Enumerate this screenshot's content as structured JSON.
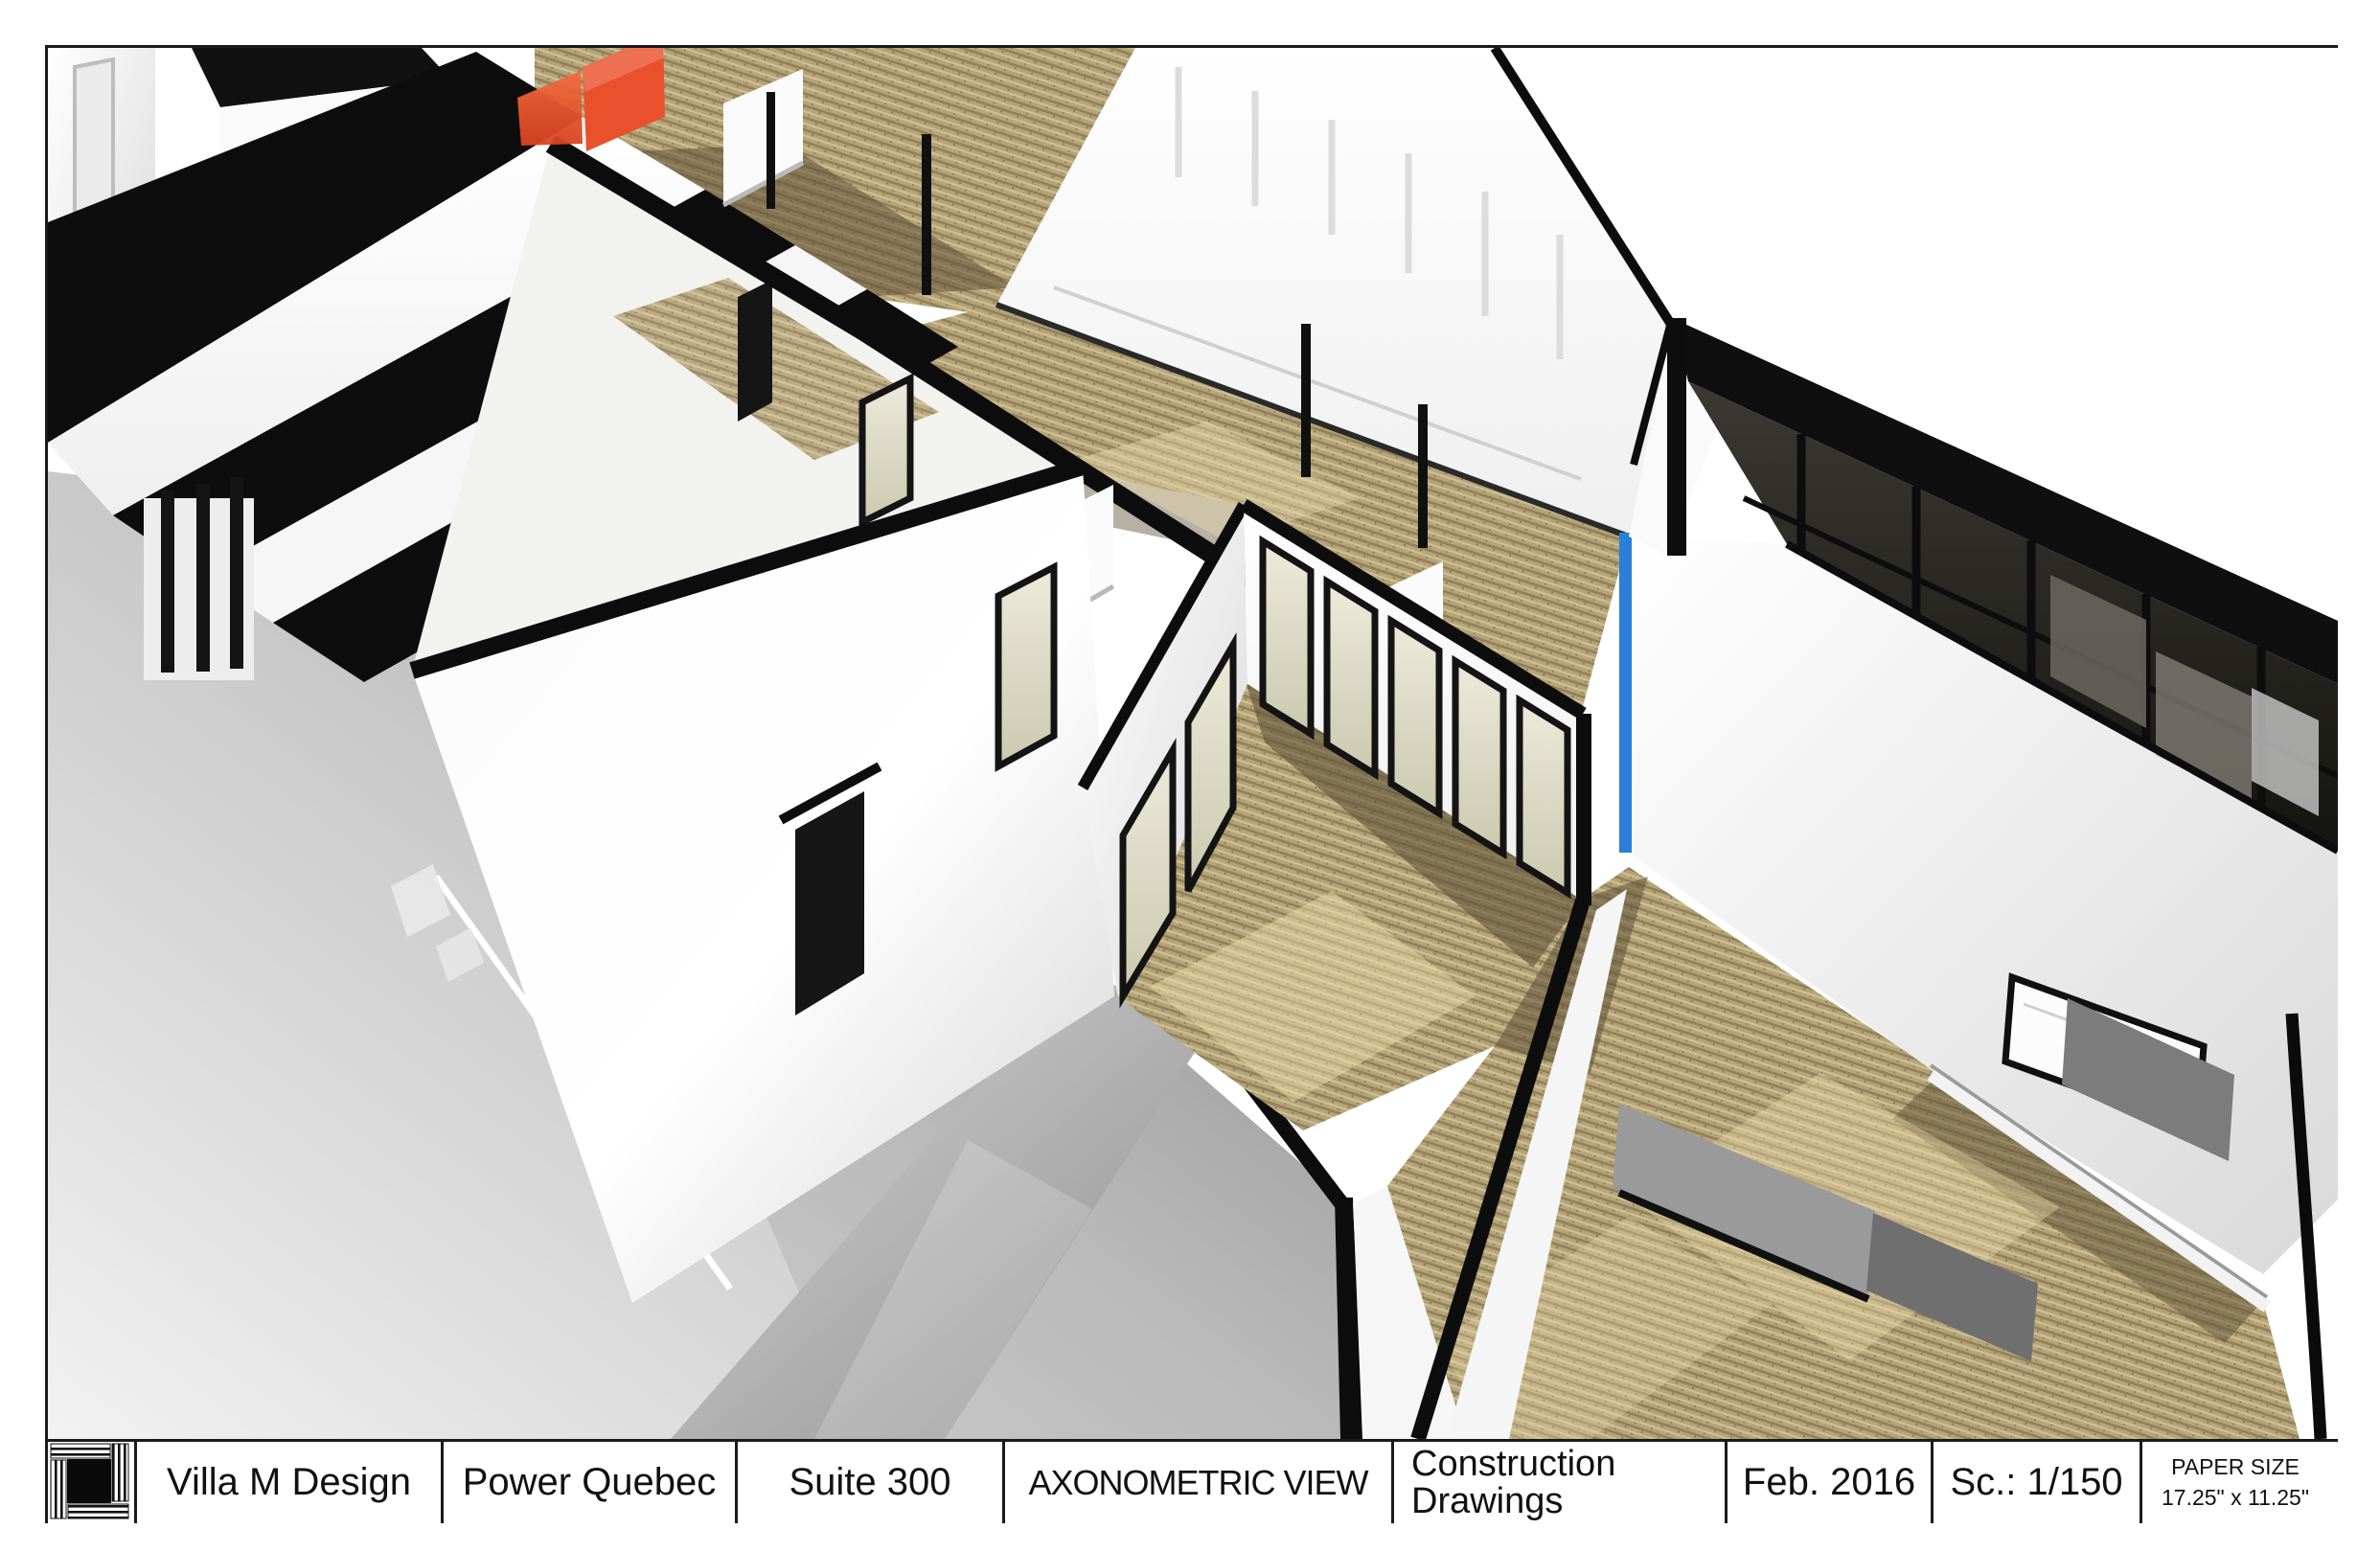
{
  "title_block": {
    "designer": "Villa M Design",
    "client": "Power Quebec",
    "suite": "Suite 300",
    "view_title": "AXONOMETRIC VIEW",
    "drawing_set_line1": "Construction",
    "drawing_set_line2": "Drawings",
    "date": "Feb. 2016",
    "scale": "Sc.: 1/150",
    "paper_size_label": "PAPER SIZE",
    "paper_size_value": "17.25\" x 11.25\""
  },
  "scene": {
    "description": "Axonometric 3D cutaway rendering of office suite interior",
    "floor_finishes": [
      "carpet",
      "concrete"
    ],
    "accent_features": [
      "orange-partition-wall",
      "blue-wall-stripe",
      "dark-glass-curtain-wall"
    ]
  },
  "colors": {
    "accent_orange": "#e8512b",
    "accent_blue": "#2a7fd8",
    "carpet": "#b5a478",
    "carpet_shadow": "#5f5138",
    "carpet_sun": "#eedfae",
    "ink": "#0d0d0d"
  }
}
